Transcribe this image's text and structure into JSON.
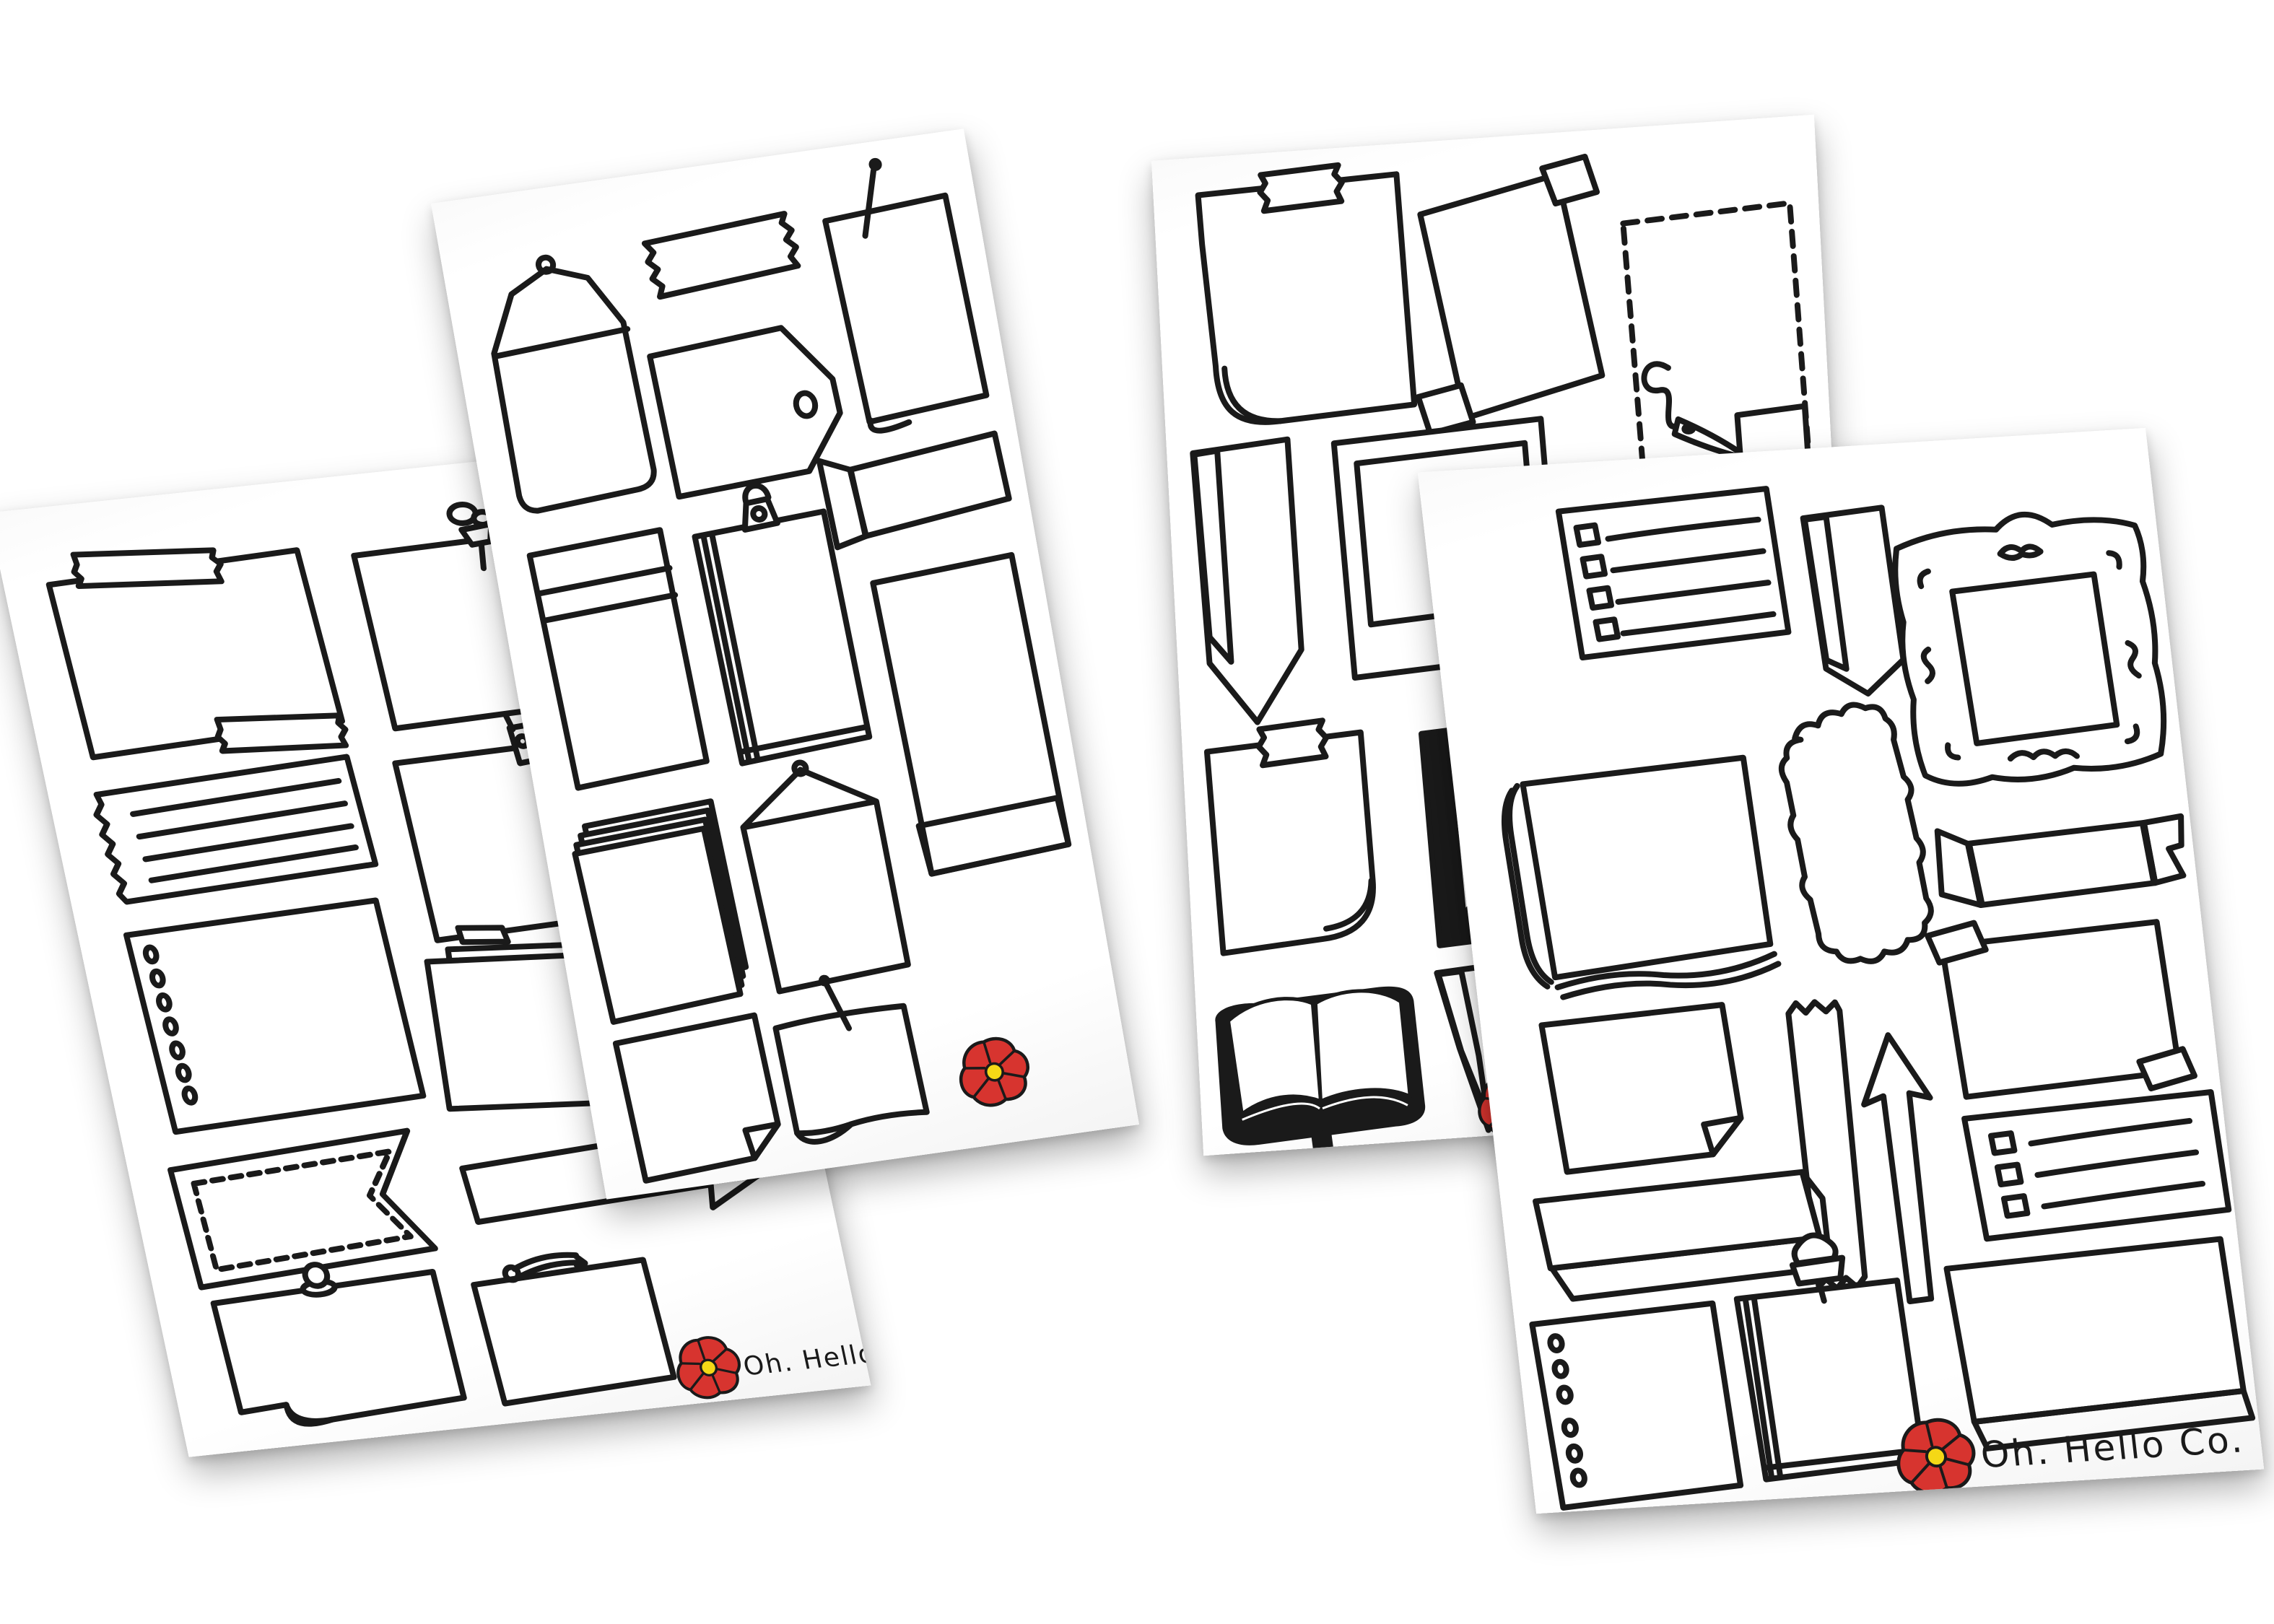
{
  "brand": {
    "name": "Oh. Hello Co."
  },
  "palette": {
    "ink": "#1a1a1a",
    "paper": "#ffffff",
    "background": "#ffffff",
    "flower_red": "#d7342f",
    "flower_center_yellow": "#f4d816"
  },
  "scene": {
    "description": "Four tilted white sticker sheets fanned out on a white background, each covered with hand-drawn black doodle stickers (notes, frames, tapes, banners, envelopes, arrows, books); each sheet is signed with a red poppy flower logo.",
    "sheet_count": 4
  },
  "sheets": [
    {
      "id": "sheet-1",
      "rotation_deg": -6,
      "logo": {
        "icon": "red-poppy-flower-icon",
        "text": "Oh. Hello Co."
      },
      "stickers": [
        "washi-taped-note",
        "pushpin-note",
        "torn-lined-paper-strip",
        "clothespin-clip-note",
        "hole-punched-page",
        "stacked-papers",
        "ribbon-banner-partial",
        "stitched-swallowtail-flag",
        "right-arrow-outline",
        "round-tack-curled-note",
        "safety-pin-note"
      ]
    },
    {
      "id": "sheet-2",
      "rotation_deg": -8,
      "logo": {
        "icon": "red-poppy-flower-icon"
      },
      "stickers": [
        "loop-clasp-envelope",
        "washi-tape-strip",
        "long-pin-curled-note",
        "gift-tag",
        "banded-pocket-folder",
        "binder-clip-note-pad",
        "folded-ribbon-banner",
        "hatched-bottom-panel",
        "stacked-papers",
        "flap-envelope",
        "dog-ear-square-note",
        "pinned-wavy-note"
      ]
    },
    {
      "id": "sheet-3",
      "rotation_deg": -4,
      "logo": {
        "icon": "red-poppy-flower-icon"
      },
      "stickers": [
        "taped-curl-note",
        "double-taped-tilted-note",
        "dashed-cutout-with-needle-and-thread",
        "hatched-chevron-banner",
        "polaroid-frame",
        "plain-panel-partially-hidden",
        "taped-note-with-curl",
        "black-beveled-frame",
        "open-book",
        "washi-tape-strip",
        "hatched-pennant"
      ]
    },
    {
      "id": "sheet-4",
      "rotation_deg": -3.5,
      "logo": {
        "icon": "red-poppy-flower-icon",
        "text": "Oh. Hello Co."
      },
      "stickers": [
        "checklist-card",
        "hatched-bookmark-chevron",
        "ornate-scroll-frame",
        "layered-notebook",
        "scalloped-label",
        "forked-ribbon-banner",
        "corner-taped-note",
        "dog-ear-note",
        "washi-tape-strip-vertical",
        "up-arrow-outline",
        "checklist-card-large",
        "hatched-3d-bar",
        "hole-punched-page",
        "pushpin-note-pad",
        "hatched-shadow-square"
      ]
    }
  ]
}
